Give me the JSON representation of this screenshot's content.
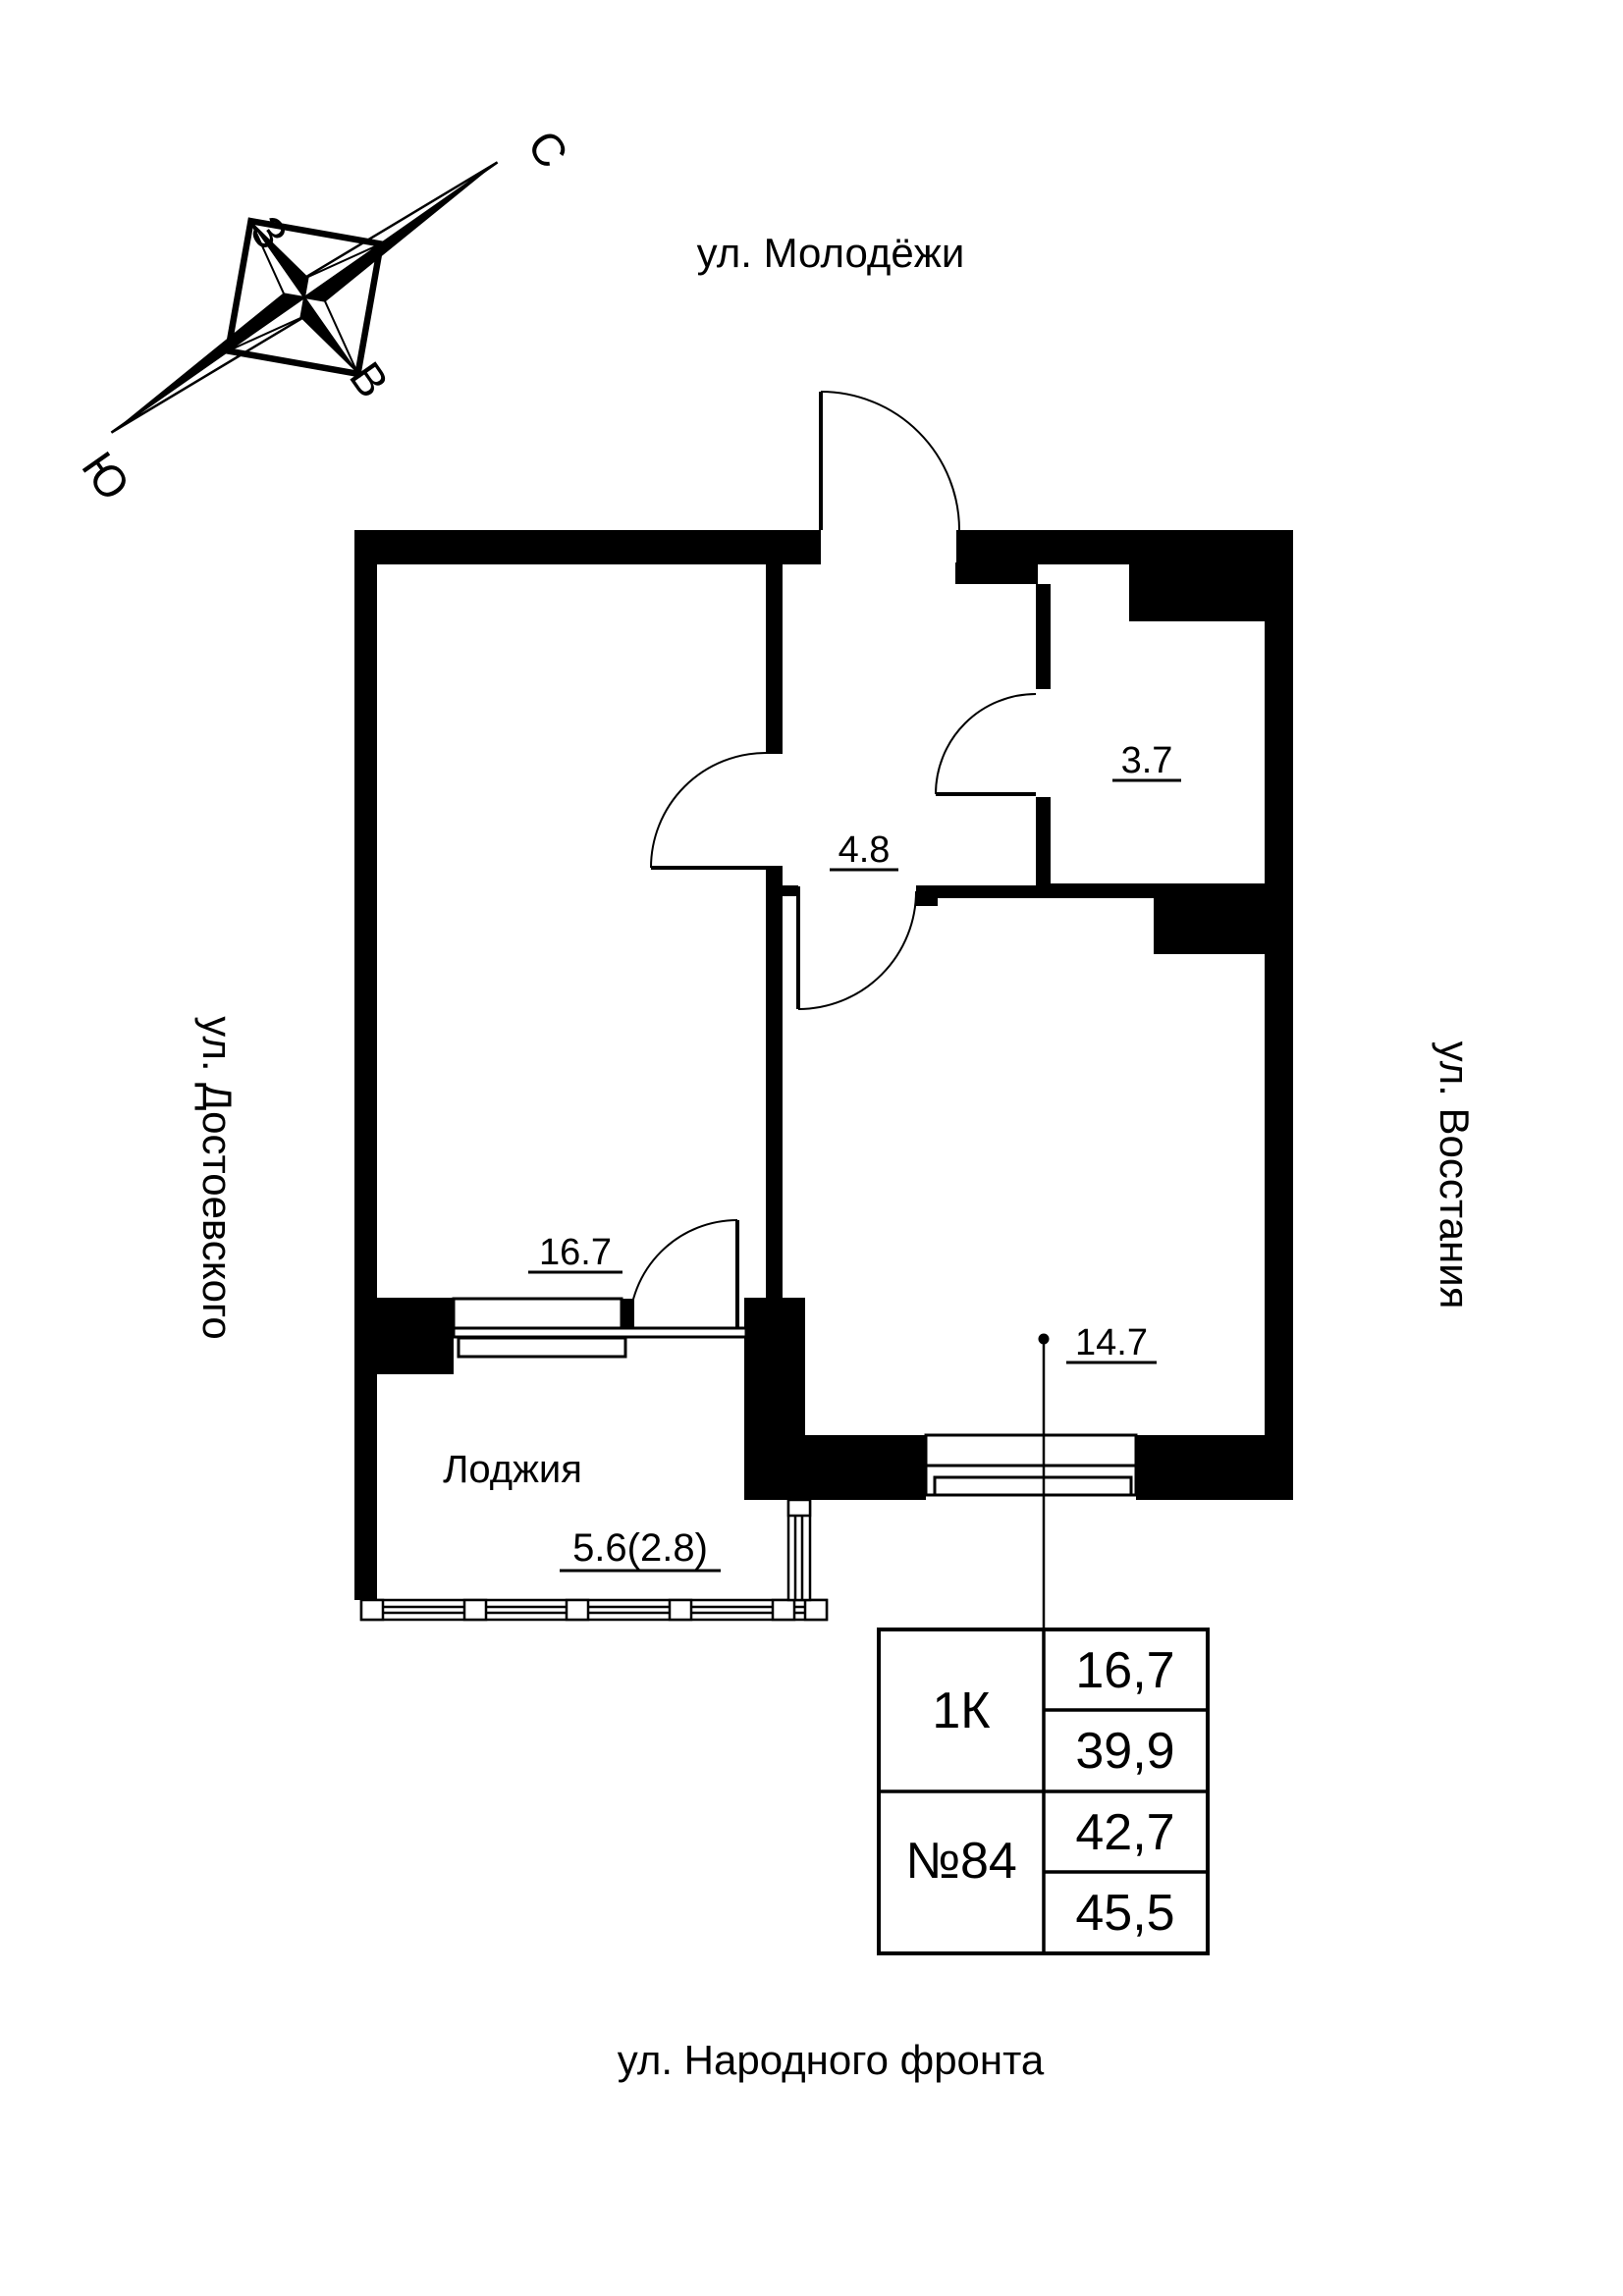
{
  "compass": {
    "north": "С",
    "south": "Ю",
    "west": "З",
    "east": "В"
  },
  "streets": {
    "top": "ул. Молодёжи",
    "left": "ул. Достоевского",
    "right": "ул. Восстания",
    "bottom": "ул. Народного фронта"
  },
  "rooms": {
    "bathroom": {
      "area": "3.7"
    },
    "hallway": {
      "area": "4.8"
    },
    "room": {
      "area": "16.7"
    },
    "living": {
      "area": "14.7"
    },
    "loggia": {
      "name": "Лоджия",
      "area": "5.6(2.8)"
    }
  },
  "info_table": {
    "flat_type": "1К",
    "flat_number": "№84",
    "living_area": "16,7",
    "area_without_loggia": "39,9",
    "area_with_coef": "42,7",
    "area_total": "45,5"
  },
  "colors": {
    "ink": "#000000",
    "background": "#ffffff"
  }
}
